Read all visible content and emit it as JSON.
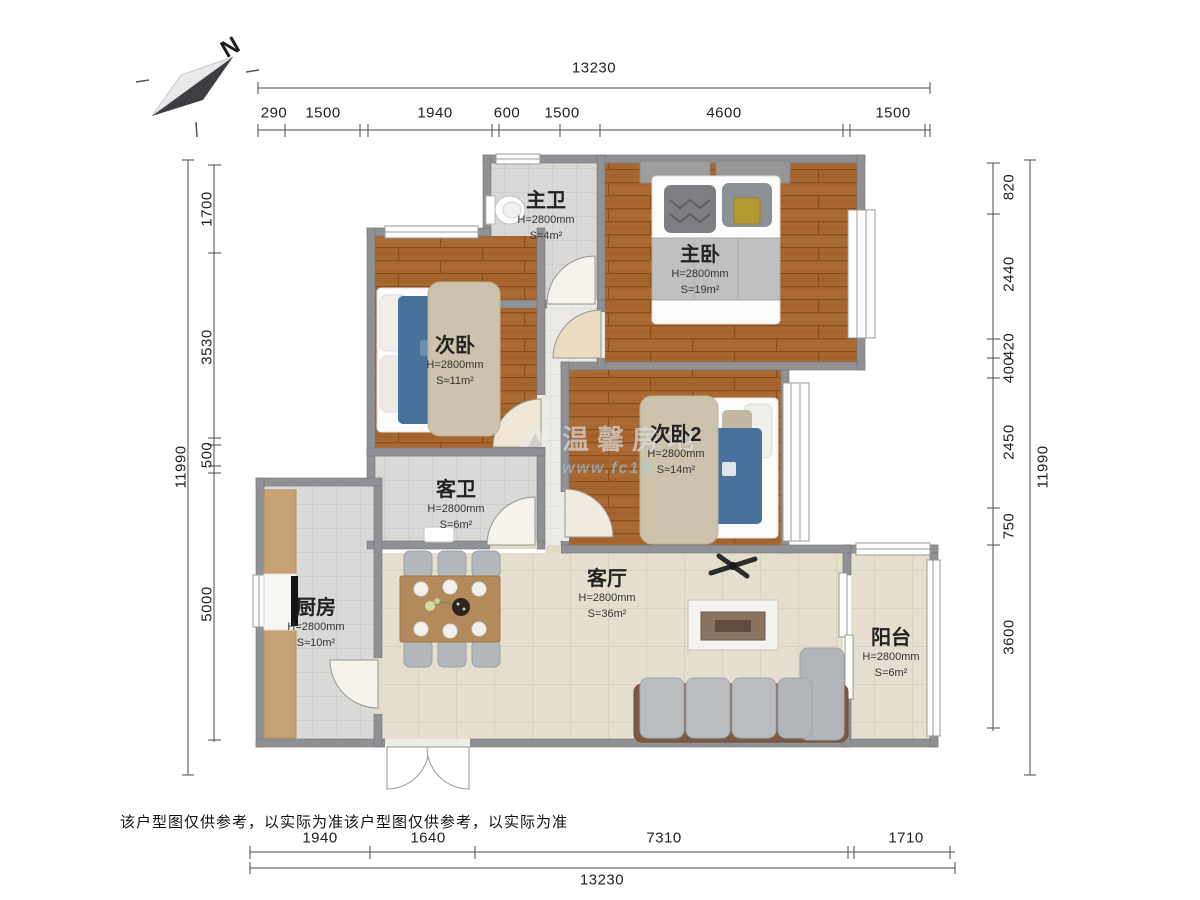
{
  "compass": {
    "north_label": "N"
  },
  "watermark": {
    "brand": "温馨房地",
    "url": "www.fc10"
  },
  "disclaimer": "该户型图仅供参考，以实际为准该户型图仅供参考，以实际为准",
  "rooms": [
    {
      "name": "主卫",
      "height": "H=2800mm",
      "area": "S=4m²"
    },
    {
      "name": "主卧",
      "height": "H=2800mm",
      "area": "S=19m²"
    },
    {
      "name": "次卧",
      "height": "H=2800mm",
      "area": "S≈11m²"
    },
    {
      "name": "次卧2",
      "height": "H=2800mm",
      "area": "S≈14m²"
    },
    {
      "name": "客卫",
      "height": "H=2800mm",
      "area": "S=6m²"
    },
    {
      "name": "厨房",
      "height": "H=2800mm",
      "area": "S≈10m²"
    },
    {
      "name": "客厅",
      "height": "H=2800mm",
      "area": "S=36m²"
    },
    {
      "name": "阳台",
      "height": "H=2800mm",
      "area": "S=6m²"
    }
  ],
  "dimensions": {
    "top": {
      "total": "13230",
      "segments": [
        "290",
        "1500",
        "1940",
        "600",
        "1500",
        "4600",
        "1500"
      ]
    },
    "bottom": {
      "total": "13230",
      "segments": [
        "1940",
        "1640",
        "7310",
        "1710"
      ]
    },
    "left": {
      "total": "11990",
      "segments": [
        "1700",
        "3530",
        "500",
        "5000"
      ]
    },
    "right": {
      "total": "11990",
      "segments": [
        "820",
        "2440",
        "420",
        "400",
        "2450",
        "750",
        "3600"
      ]
    }
  },
  "colors": {
    "wall": "#8f9194",
    "wood_floor": "#a86730",
    "bath_tile": "#d9d9d7",
    "living_tile": "#e6dfcf",
    "bed_blue": "#48719c",
    "sofa_frame": "#7b5b45"
  }
}
